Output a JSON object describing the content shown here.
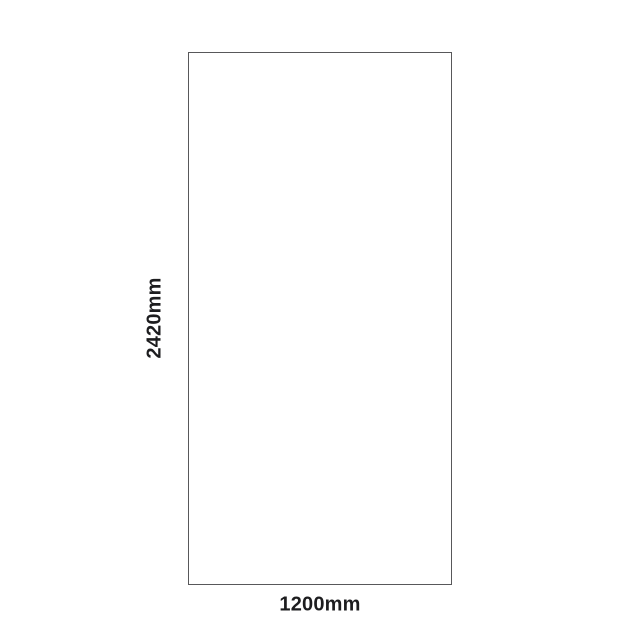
{
  "diagram": {
    "type": "dimension-drawing",
    "shape": "rectangle",
    "height_label": "2420mm",
    "width_label": "1200mm",
    "height_mm": 2420,
    "width_mm": 1200
  },
  "colors": {
    "background": "#ffffff",
    "outline": "#58585a",
    "label_text": "#1d1d1f"
  }
}
